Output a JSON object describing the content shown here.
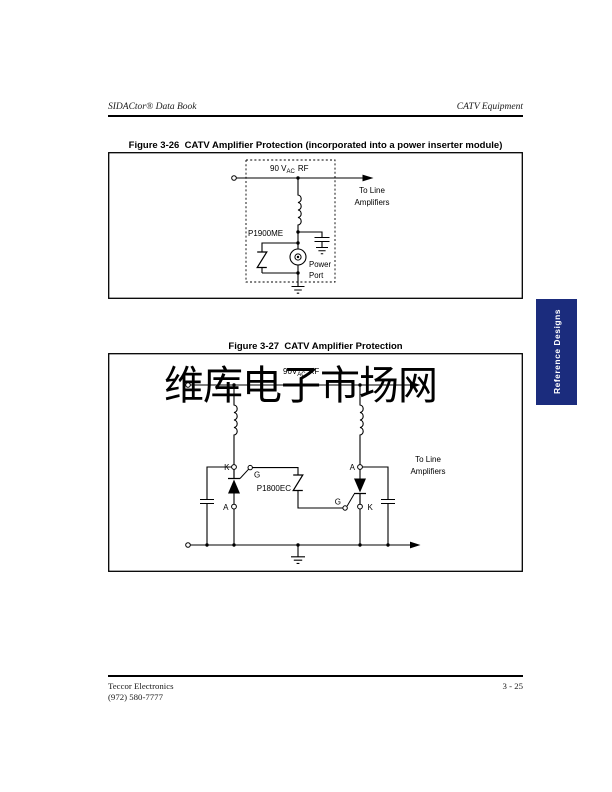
{
  "header": {
    "left": "SIDACtor® Data Book",
    "right": "CATV Equipment"
  },
  "side_tab": {
    "label": "Reference Designs",
    "color": "#1b2c7d"
  },
  "watermark": {
    "text": "维库电子市场网",
    "color": "#dcdcdc"
  },
  "figure26": {
    "title": "Figure 3-26  CATV Amplifier Protection (incorporated into a power inserter module)",
    "labels": {
      "voltage_prefix": "90 V",
      "voltage_sub": "AC",
      "voltage_suffix": "RF",
      "to_line_1": "To Line",
      "to_line_2": "Amplifiers",
      "device": "P1900ME",
      "port_1": "Power",
      "port_2": "Port"
    }
  },
  "figure27": {
    "title": "Figure 3-27  CATV Amplifier Protection",
    "labels": {
      "voltage_prefix": "90V",
      "voltage_sub": "AC",
      "voltage_suffix": "RF",
      "to_line_1": "To Line",
      "to_line_2": "Amplifiers",
      "device": "P1800EC",
      "k_left": "K",
      "g_left": "G",
      "a_left": "A",
      "a_right": "A",
      "g_right": "G",
      "k_right": "K"
    }
  },
  "footer": {
    "company": "Teccor Electronics",
    "phone": "(972) 580-7777",
    "page_number": "3 - 25"
  }
}
